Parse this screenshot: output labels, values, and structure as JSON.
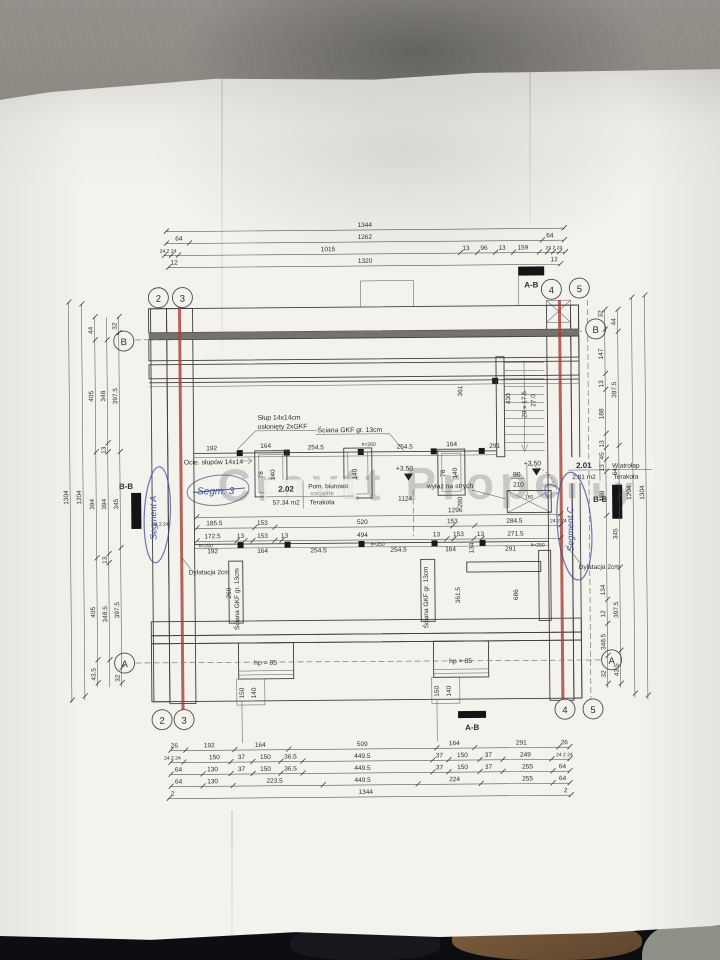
{
  "photo": {
    "floor_color": "#8a8780",
    "table_color": "#0c0c10",
    "boot_color": "#6e5236",
    "paper_color": "#f3f2ed",
    "dilatation_red": "#a63f36",
    "ink_blue": "#3b4fa0"
  },
  "watermark": "Cravtt Property",
  "mark": {
    "ab": "A-B",
    "bb": "B-B",
    "l1": "+3.50",
    "l2": "+3.50"
  },
  "grid": {
    "c2": "2",
    "c3": "3",
    "c4": "4",
    "c5": "5",
    "rA": "A",
    "rB": "B"
  },
  "rooms": {
    "r202": {
      "no": "2.02",
      "area": "57.34 m2",
      "name1": "Pom. biurowo",
      "name2": "socjalne",
      "floor": "Terakota"
    },
    "r201": {
      "no": "2.01",
      "area": "2.81 m2",
      "name": "Wiatrołap",
      "floor": "Terakota"
    }
  },
  "call": {
    "slup1": "Słup 14x14cm",
    "slup2": "osłonięty 2xGKF",
    "sciana": "Ściana GKF gr. 13cm",
    "ociepl": "Ocie. słupów 14x14",
    "dylat": "Dylatacja 2cm",
    "wylaz": "wyłaz na strych",
    "hp": "hp = 85",
    "door_w": "90",
    "door_h": "210",
    "ladder": "160",
    "h260": "h=260"
  },
  "hand": {
    "a": "Segment A",
    "c": "Segment C",
    "s3": "Segm. 3"
  },
  "dims": {
    "t1": [
      "1344"
    ],
    "t2": [
      "64",
      "1262",
      "64"
    ],
    "t3": [
      "24 2 24",
      "1015",
      "13",
      "96",
      "13",
      "159",
      "24 2 24"
    ],
    "t4": [
      "12",
      "1320",
      "12"
    ],
    "b1": [
      "26",
      "192",
      "164",
      "509",
      "164",
      "291",
      "26"
    ],
    "b2": [
      "24 2 24",
      "150",
      "37",
      "150",
      "36.5",
      "449.5",
      "37",
      "150",
      "37",
      "249",
      "24 2 24"
    ],
    "b3": [
      "64",
      "130",
      "37",
      "150",
      "36.5",
      "449.5",
      "37",
      "150",
      "37",
      "255",
      "64"
    ],
    "b4": [
      "64",
      "130",
      "223.5",
      "449.5",
      "224",
      "255",
      "64"
    ],
    "b5": [
      "2",
      "1344",
      "2"
    ],
    "l1": [
      "1304"
    ],
    "l2": [
      "1204"
    ],
    "l3": [
      "44",
      "405",
      "394",
      "405",
      "43.5"
    ],
    "l4": [
      "348",
      "13",
      "394",
      "13",
      "348.5"
    ],
    "l5": [
      "32",
      "397.5",
      "345",
      "397.5",
      "32"
    ],
    "r1": [
      "32",
      "147",
      "13",
      "188",
      "13",
      "45",
      "13",
      "159",
      "134",
      "12",
      "348.5",
      "32"
    ],
    "r2": [
      "44",
      "397.5",
      "64",
      "345",
      "397.5",
      "43.5"
    ],
    "r3": [
      "1204"
    ],
    "r4": [
      "1304"
    ],
    "m0": [
      "1296"
    ],
    "m1": [
      "24 2 24",
      "185.5",
      "153",
      "520",
      "153",
      "284.5",
      "24 2 24"
    ],
    "m2": [
      "172.5",
      "13",
      "153",
      "13",
      "494",
      "13",
      "153",
      "13",
      "271.5"
    ],
    "m3": [
      "192",
      "164",
      "254.5",
      "254.5",
      "164",
      "134",
      "291"
    ],
    "m4": [
      "1124"
    ],
    "g1": [
      "192",
      "164",
      "254.5",
      "254.5",
      "164",
      "291"
    ],
    "win": [
      "78",
      "140",
      "140",
      "78",
      "140"
    ],
    "stair": [
      "361",
      "430",
      "20 x 17.5",
      "27.0"
    ],
    "vdims": [
      "280",
      "260",
      "361.5",
      "686"
    ],
    "bwin": [
      "150",
      "140",
      "150",
      "140"
    ],
    "h250": [
      "h=250",
      "h=250",
      "h=250"
    ]
  }
}
